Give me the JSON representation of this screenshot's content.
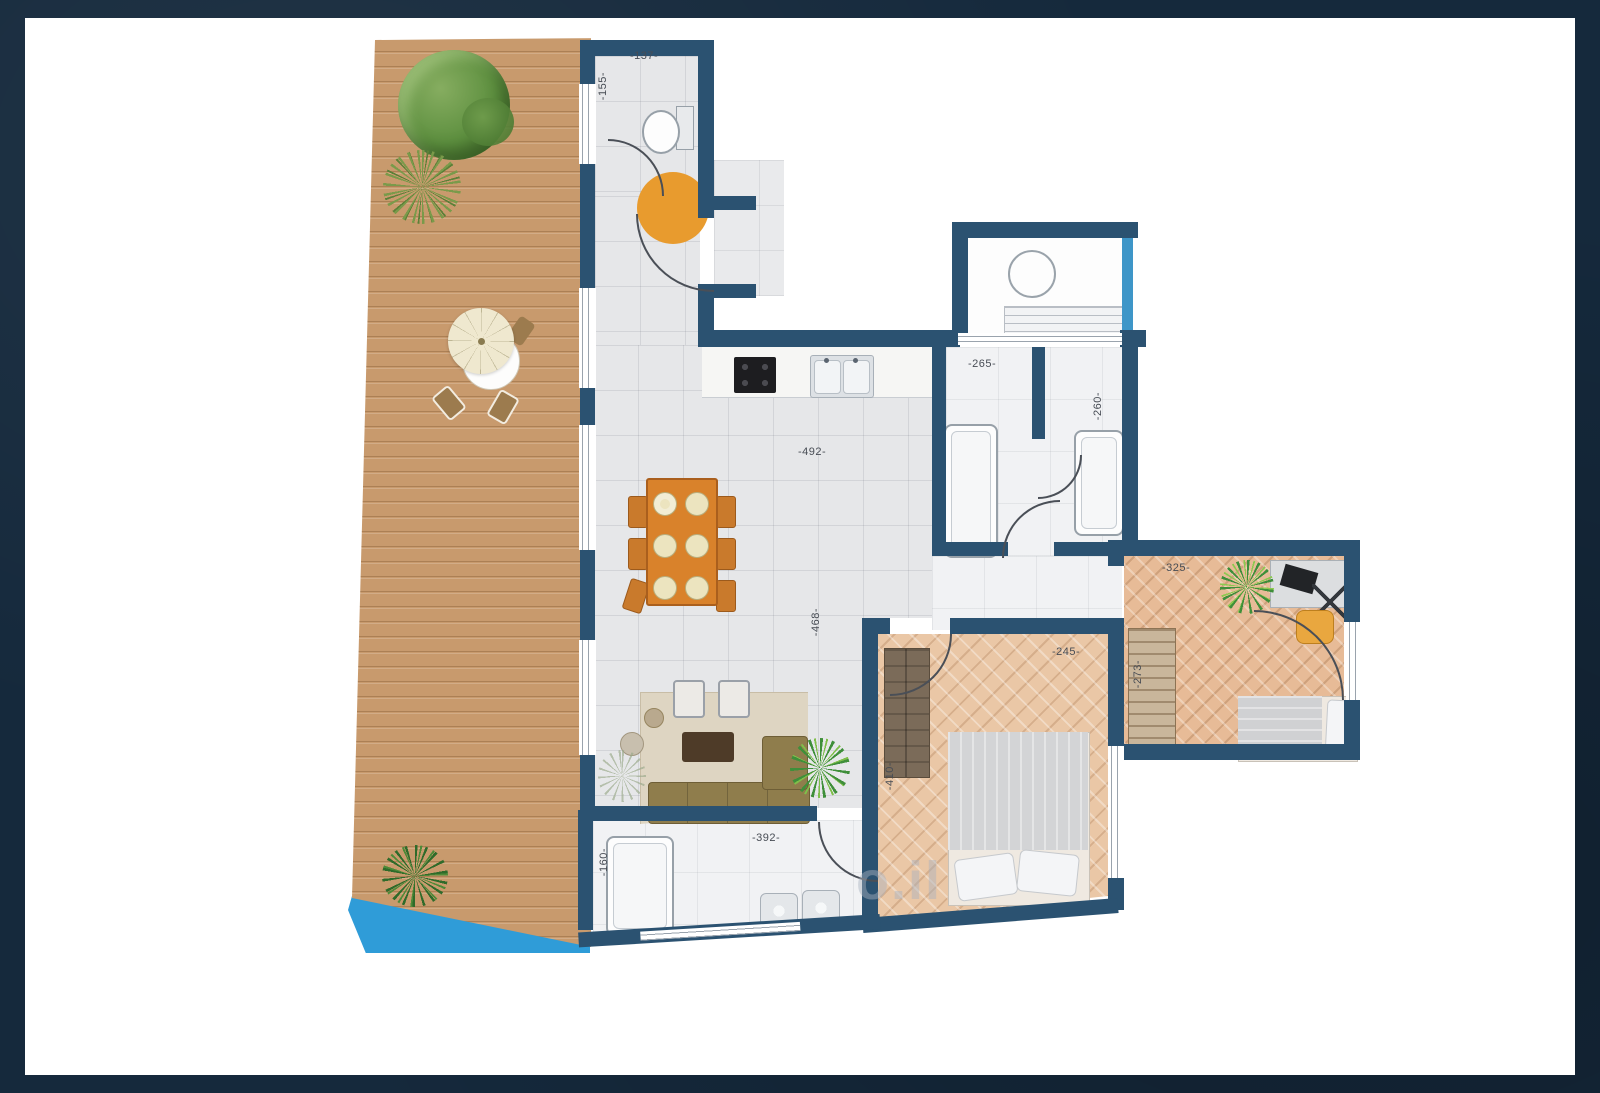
{
  "image_type": "architectural floor plan — top-down color rendering of an apartment with large wooden terrace",
  "dimension_labels": [
    {
      "id": "wc-width",
      "text": "-137-",
      "orientation": "horizontal"
    },
    {
      "id": "wc-depth",
      "text": "-155-",
      "orientation": "vertical"
    },
    {
      "id": "bathroom-width",
      "text": "-265-",
      "orientation": "horizontal"
    },
    {
      "id": "bathroom2-depth",
      "text": "-260-",
      "orientation": "vertical"
    },
    {
      "id": "living-width",
      "text": "-492-",
      "orientation": "horizontal"
    },
    {
      "id": "living-depth",
      "text": "-468-",
      "orientation": "vertical"
    },
    {
      "id": "masterbath-width",
      "text": "-392-",
      "orientation": "horizontal"
    },
    {
      "id": "masterbath-depth",
      "text": "-160-",
      "orientation": "vertical"
    },
    {
      "id": "master-width",
      "text": "-245-",
      "orientation": "horizontal"
    },
    {
      "id": "master-depth",
      "text": "-410-",
      "orientation": "vertical"
    },
    {
      "id": "bedroom2-wall",
      "text": "-273-",
      "orientation": "vertical"
    },
    {
      "id": "bedroom2-width",
      "text": "-325-",
      "orientation": "horizontal"
    }
  ],
  "watermark": {
    "text": "o.il"
  },
  "colors": {
    "frame": "#15293c",
    "wall": "#2b5271",
    "glass": "#3e96c8",
    "tile": "#e6e7e9",
    "marble": "#f1f2f4",
    "deck": "#c89a6d",
    "pool": "#2f9cd8",
    "wood1": "#eac7a6",
    "wood2": "#e7bb97",
    "accent_orange": "#e89b2e"
  }
}
